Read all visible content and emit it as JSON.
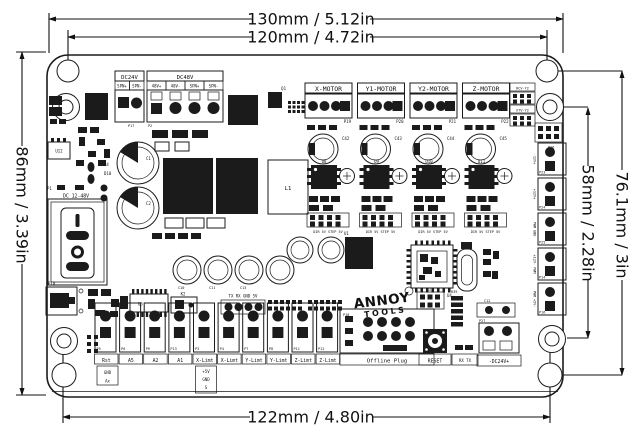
{
  "dimensions": {
    "width_outer": "130mm / 5.12in",
    "width_holes": "120mm / 4.72in",
    "height_left": "86mm / 3.39in",
    "height_holes_right": "58mm / 2.28in",
    "height_right": "76.1mm / 3in",
    "width_bottom_holes": "122mm / 4.80in"
  },
  "board": {
    "power_in": {
      "dc24v": {
        "title": "DC24V",
        "pins": [
          "SPN+",
          "SPN-"
        ],
        "port": "P17"
      },
      "dc48v": {
        "title": "DC48V",
        "pins": [
          "48V+",
          "48V-",
          "SPN+",
          "SPN-"
        ],
        "port": "P2"
      }
    },
    "motors": [
      {
        "label": "X-MOTOR",
        "port": "P19",
        "ic": "U8",
        "cap": "C42",
        "header": "DIR 5V STEP 5V"
      },
      {
        "label": "Y1-MOTOR",
        "port": "P20",
        "ic": "U9",
        "cap": "C43",
        "header": "DIR 5V STEP 5V"
      },
      {
        "label": "Y2-MOTOR",
        "port": "P21",
        "ic": "U10",
        "cap": "C44",
        "header": "DIR 5V STEP 5V"
      },
      {
        "label": "Z-MOTOR",
        "port": "P22",
        "ic": "U11",
        "cap": "C45",
        "header": "DIR 5V STEP 5V"
      }
    ],
    "jumpers": [
      {
        "label": "RCV-Y2"
      },
      {
        "label": "XTV-Y2"
      }
    ],
    "left": {
      "p1": "P1",
      "range": "DC 12-48V",
      "u12": "U12",
      "usb_port": "P10",
      "r4": "R4",
      "d10": "D10",
      "c1": "C1",
      "c2": "C2"
    },
    "center": {
      "q1": "Q1",
      "l1": "L1",
      "u1": "U1",
      "u5": "U5",
      "k2": "K2",
      "uart": "TX RX GND 5V",
      "caps": [
        "C10",
        "C11",
        "C13"
      ],
      "logo": [
        "ANNOY",
        "TOOLS"
      ],
      "u4": "U4",
      "p15": "P15",
      "r39": "R39"
    },
    "bottom": {
      "ports": [
        {
          "port": "P5",
          "label": "Rst"
        },
        {
          "port": "P6",
          "label": "A5"
        },
        {
          "port": "P9",
          "label": "A2"
        },
        {
          "port": "P13",
          "label": "A1"
        },
        {
          "port": "P3",
          "label": "X-Limt"
        },
        {
          "port": "P4",
          "label": "X-Limt"
        },
        {
          "port": "P7",
          "label": "Y-Limt"
        },
        {
          "port": "P8",
          "label": "Y-Limt"
        },
        {
          "port": "P11",
          "label": "Z-Limt"
        },
        {
          "port": "P12",
          "label": "Z-Limt"
        }
      ],
      "rst_sub": [
        "GND",
        "Ax"
      ],
      "limit_sub": [
        "+5V",
        "GND",
        "S"
      ],
      "offline": {
        "port": "P18",
        "label": "Offline Plug"
      },
      "reset_label": "RESET",
      "rxtx_label": "RX TX",
      "dcout": {
        "cap": "C12",
        "port": "P27",
        "label": "-DC24V+"
      }
    },
    "right": {
      "p26": "P26",
      "ports": [
        {
          "port": "P23",
          "label": "-12V+"
        },
        {
          "port": "P24",
          "label": "+12V+"
        },
        {
          "port": "P25",
          "label": "PWM GND"
        },
        {
          "port": "P14",
          "label": "+12V- PWM"
        },
        {
          "port": "P16",
          "label": "PWM +5V-"
        }
      ]
    }
  }
}
